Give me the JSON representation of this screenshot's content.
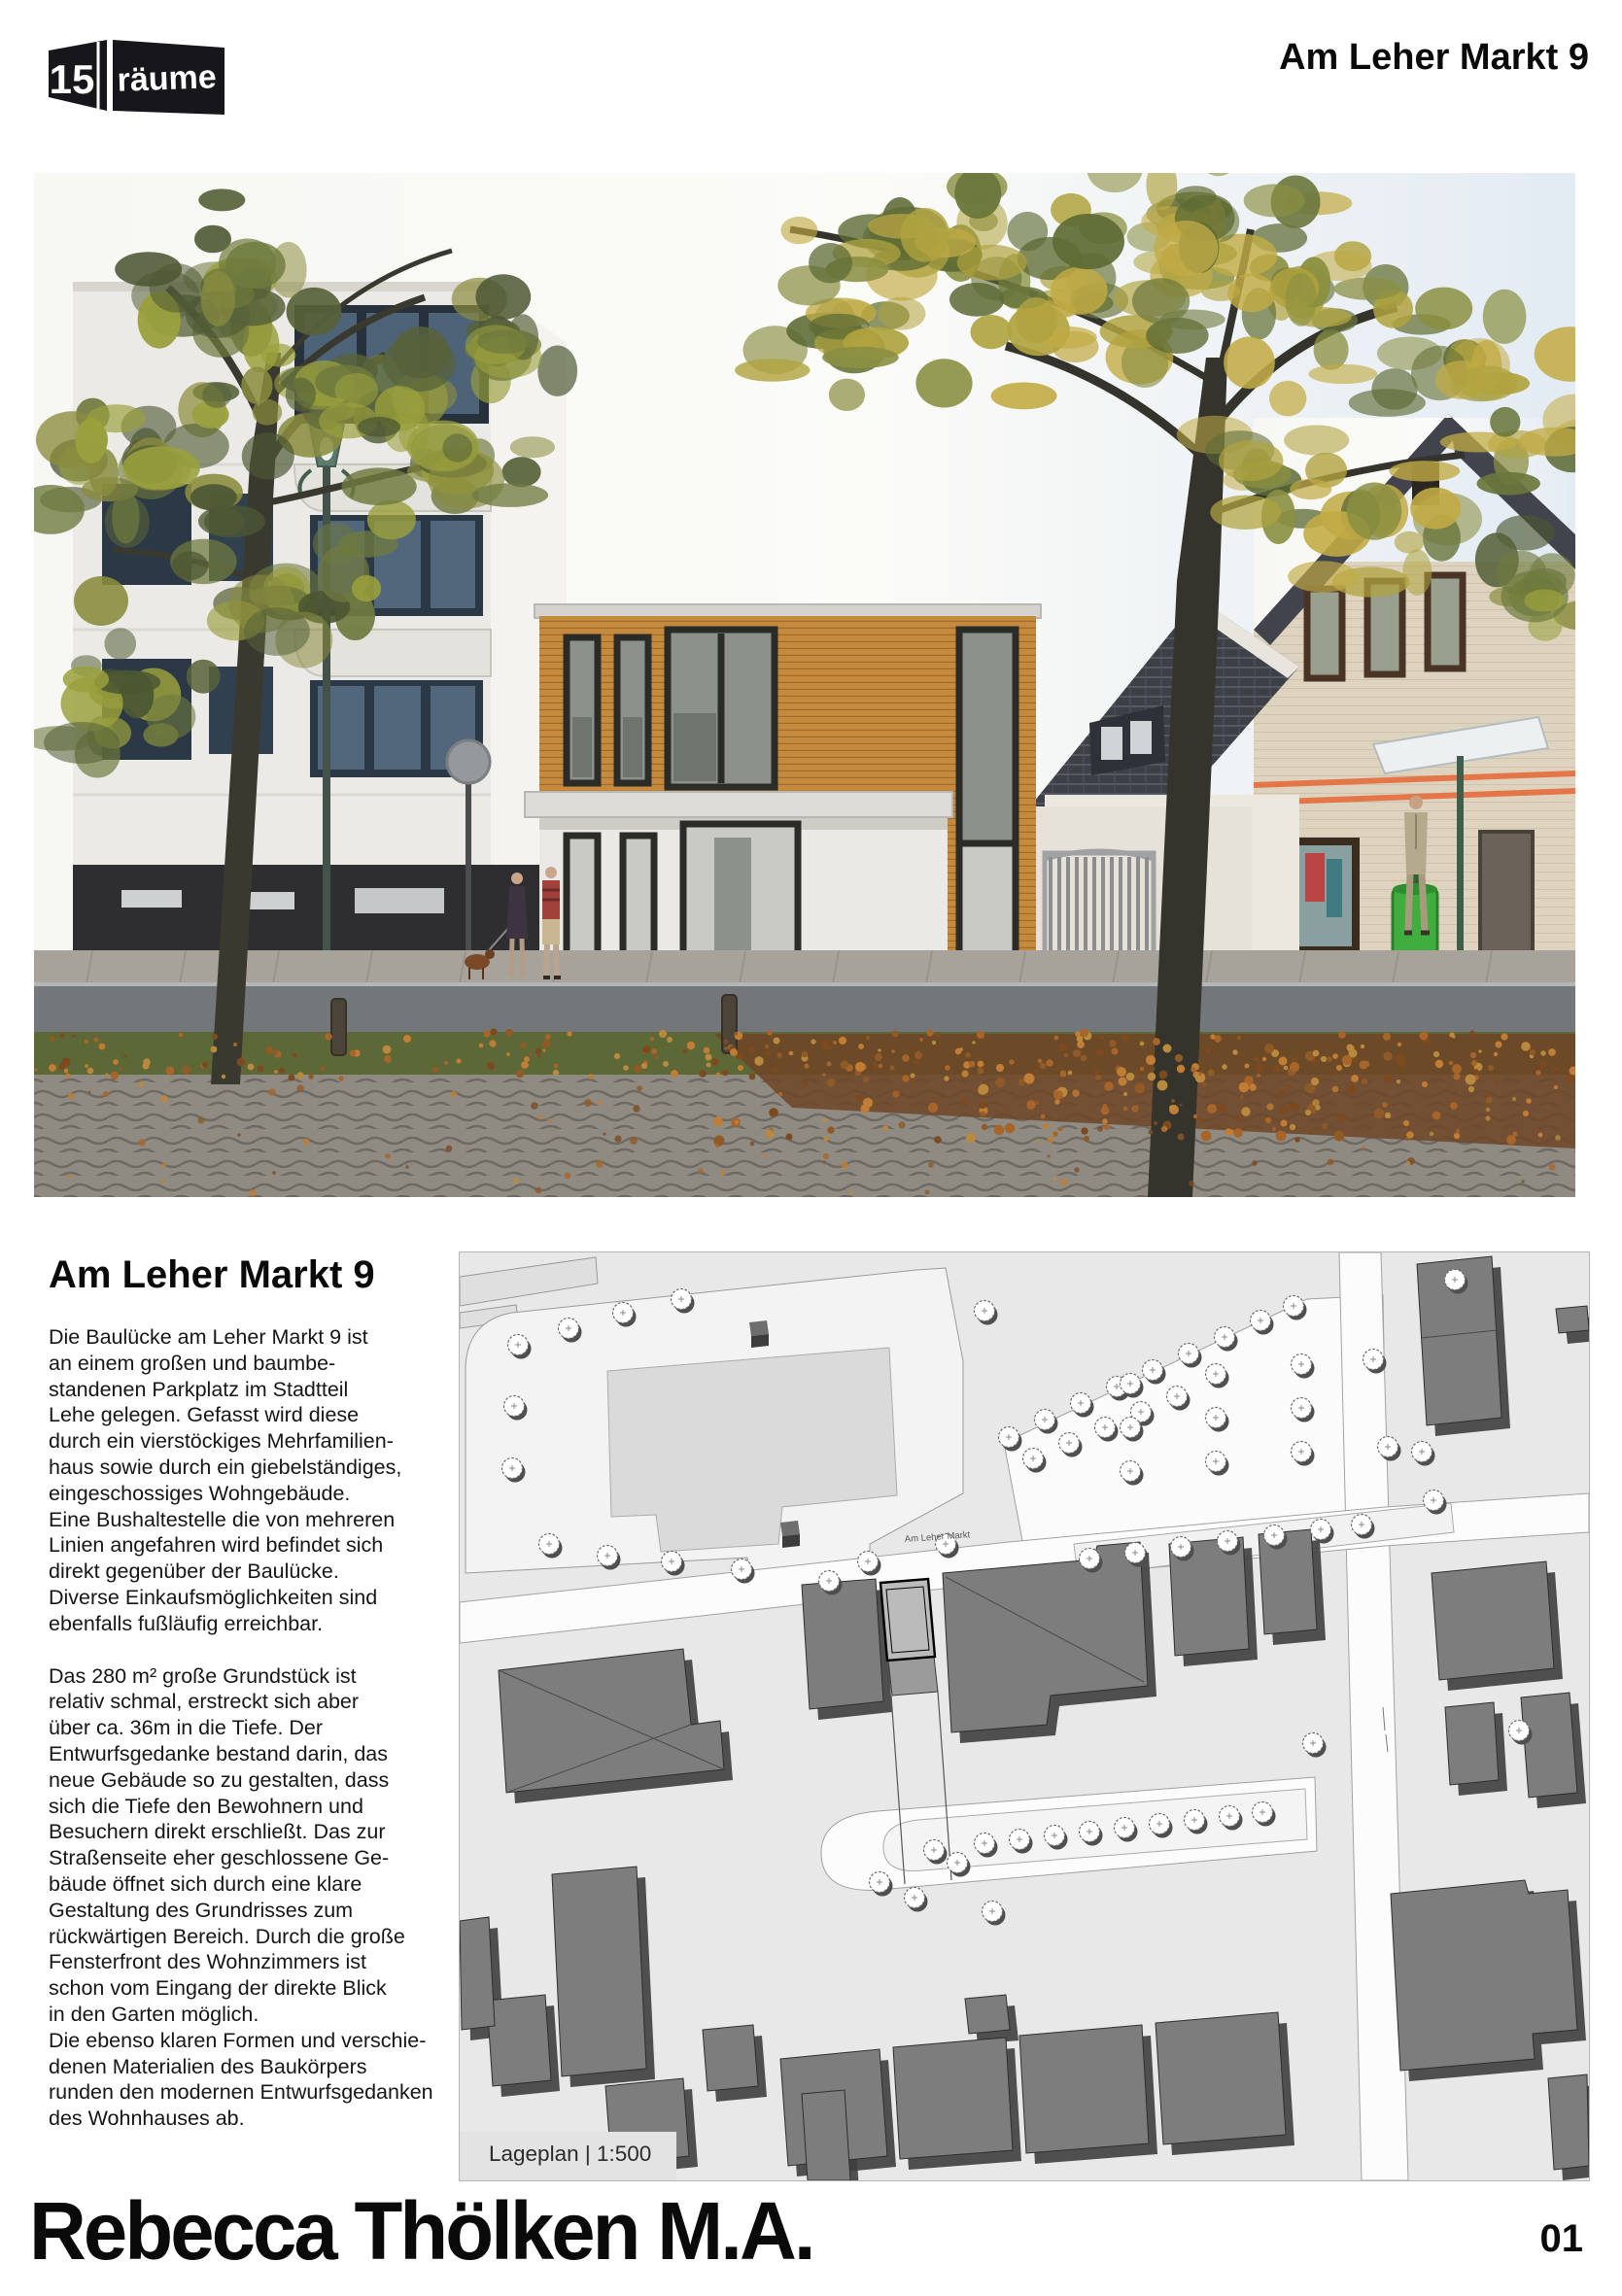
{
  "logo": {
    "number": "15",
    "word": "räume"
  },
  "header": {
    "title": "Am Leher Markt 9"
  },
  "article": {
    "heading": "Am Leher Markt 9",
    "paragraphs": [
      "Die Baulücke am Leher Markt 9 ist\nan einem großen und baumbe-\nstandenen Parkplatz im Stadtteil\nLehe gelegen. Gefasst wird diese\ndurch ein vierstöckiges Mehrfamilien-\nhaus sowie durch ein giebelständiges,\neingeschossiges Wohngebäude.\nEine Bushaltestelle die von mehreren\nLinien angefahren wird befindet sich\ndirekt gegenüber der Baulücke.\nDiverse Einkaufsmöglichkeiten sind\nebenfalls fußläufig erreichbar.",
      "Das 280 m² große Grundstück ist\nrelativ schmal, erstreckt sich aber\nüber ca. 36m in die Tiefe. Der\nEntwurfsgedanke bestand darin, das\nneue Gebäude so zu gestalten, dass\nsich die Tiefe den Bewohnern und\nBesuchern direkt erschließt. Das zur\nStraßenseite eher geschlossene Ge-\nbäude öffnet sich durch eine klare\nGestaltung des Grundrisses zum\nrückwärtigen Bereich. Durch die große\nFensterfront des Wohnzimmers ist\nschon vom Eingang der direkte Blick\nin den Garten möglich.\nDie ebenso klaren Formen und verschie-\ndenen Materialien des Baukörpers\nrunden den modernen Entwurfsgedanken\ndes Wohnhauses ab."
    ]
  },
  "siteplan": {
    "caption": "Lageplan | 1:500",
    "street_label": "Am Leher Markt"
  },
  "footer": {
    "author": "Rebecca Thölken M.A.",
    "page_number": "01"
  },
  "colors": {
    "wood": "#c68a3f",
    "plan_building": "#7d7d7d",
    "accent_black": "#0a0a0a"
  }
}
